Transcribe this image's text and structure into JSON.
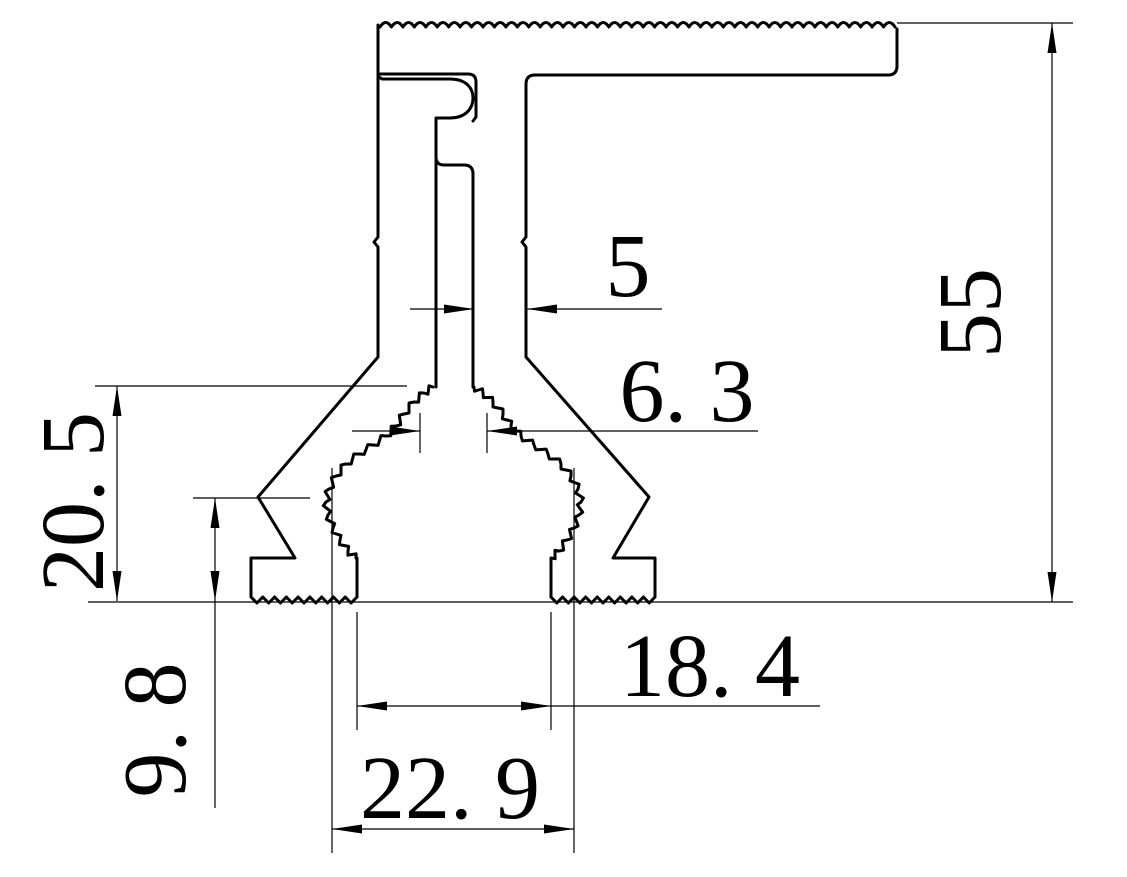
{
  "drawing": {
    "kind": "extrusion-profile-cross-section",
    "background_color": "#ffffff",
    "line_color": "#000000",
    "dimensions": {
      "overall_height": {
        "label": "55",
        "orientation": "vertical-right"
      },
      "stem_width": {
        "label": "5",
        "orientation": "horizontal"
      },
      "neck_width": {
        "label": "6. 3",
        "orientation": "horizontal"
      },
      "bulb_height": {
        "label": "20. 5",
        "orientation": "vertical-left"
      },
      "foot_step_height": {
        "label": "9. 8",
        "orientation": "vertical-left"
      },
      "feet_inner_width": {
        "label": "18. 4",
        "orientation": "horizontal-bottom"
      },
      "bulb_outer_width": {
        "label": "22. 9",
        "orientation": "horizontal-bottom"
      }
    }
  }
}
